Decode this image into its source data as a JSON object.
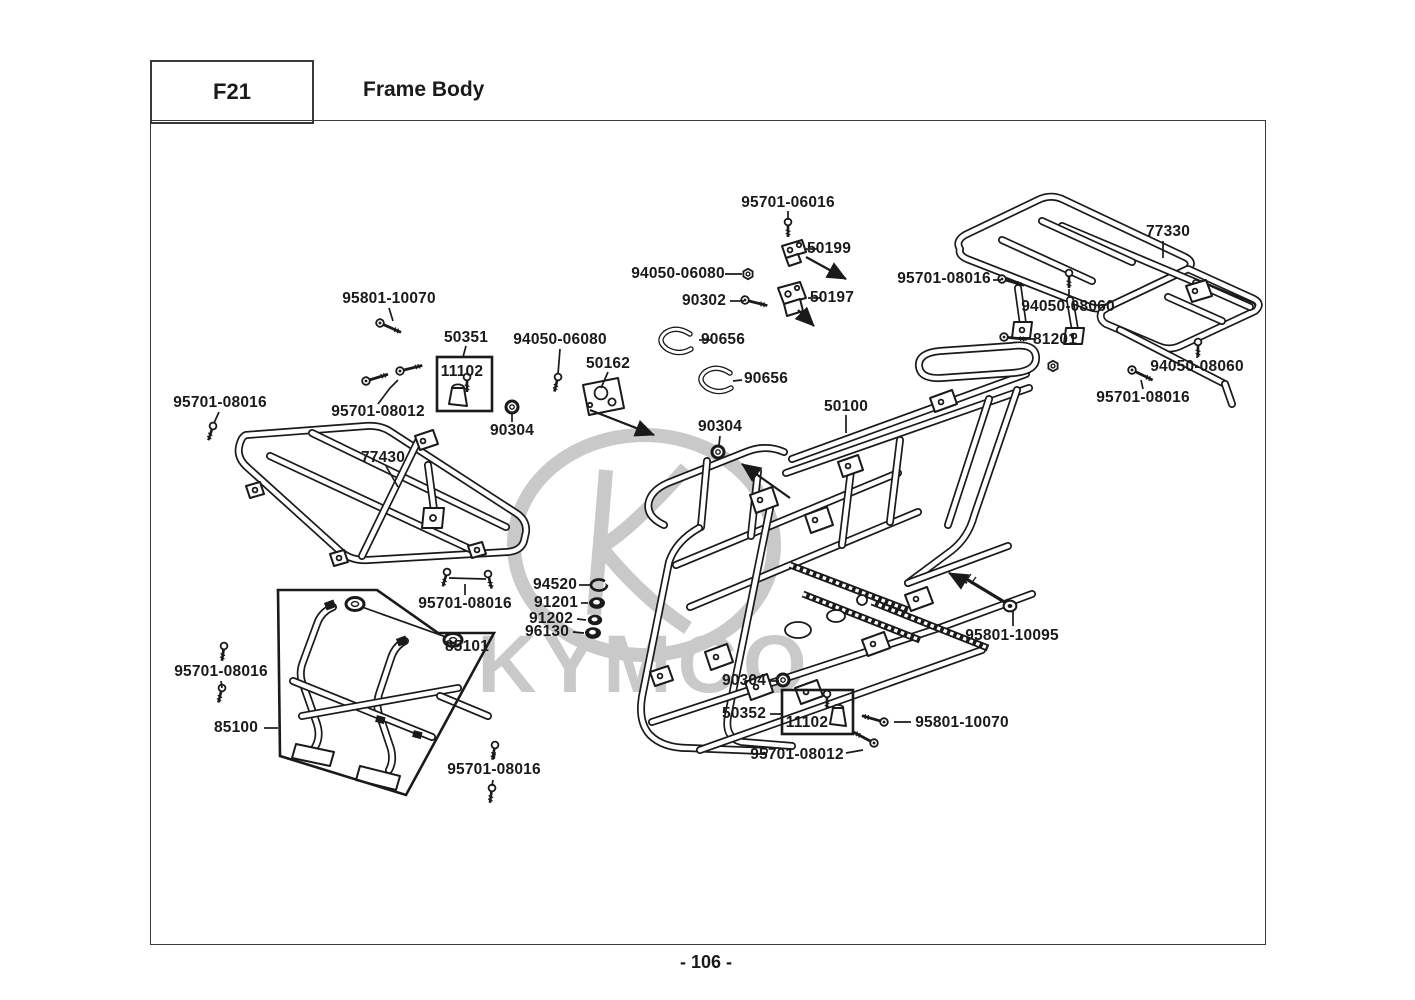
{
  "header": {
    "code": "F21",
    "title": "Frame Body"
  },
  "footer": {
    "page_label": "- 106 -"
  },
  "watermark": {
    "brand": "KYMCO"
  },
  "colors": {
    "line": "#1a1a1a",
    "watermark": "#c9c9c9",
    "background": "#ffffff"
  },
  "detail_boxes": [
    {
      "callout": "50351",
      "inner_part": "11102"
    },
    {
      "callout": "50352",
      "inner_part": "11102"
    },
    {
      "callout": "85100",
      "contains": [
        "85101"
      ]
    }
  ],
  "labels": [
    {
      "text": "95701-06016",
      "x": 788,
      "y": 203
    },
    {
      "text": "50199",
      "x": 829,
      "y": 249
    },
    {
      "text": "94050-06080",
      "x": 678,
      "y": 274
    },
    {
      "text": "90302",
      "x": 704,
      "y": 301
    },
    {
      "text": "50197",
      "x": 832,
      "y": 298
    },
    {
      "text": "77330",
      "x": 1168,
      "y": 232
    },
    {
      "text": "95701-08016",
      "x": 944,
      "y": 279
    },
    {
      "text": "94050-08060",
      "x": 1068,
      "y": 307
    },
    {
      "text": "95801-10070",
      "x": 389,
      "y": 299
    },
    {
      "text": "50351",
      "x": 466,
      "y": 338
    },
    {
      "text": "11102",
      "x": 462,
      "y": 372
    },
    {
      "text": "94050-06080",
      "x": 560,
      "y": 340
    },
    {
      "text": "50162",
      "x": 608,
      "y": 364
    },
    {
      "text": "95701-08012",
      "x": 378,
      "y": 412
    },
    {
      "text": "95701-08016",
      "x": 220,
      "y": 403
    },
    {
      "text": "90304",
      "x": 512,
      "y": 431
    },
    {
      "text": "77430",
      "x": 383,
      "y": 458
    },
    {
      "text": "90656",
      "x": 723,
      "y": 340
    },
    {
      "text": "90656",
      "x": 766,
      "y": 379
    },
    {
      "text": "81201",
      "x": 1055,
      "y": 340
    },
    {
      "text": "94050-08060",
      "x": 1197,
      "y": 367
    },
    {
      "text": "95701-08016",
      "x": 1143,
      "y": 398
    },
    {
      "text": "50100",
      "x": 846,
      "y": 407
    },
    {
      "text": "90304",
      "x": 720,
      "y": 427
    },
    {
      "text": "94520",
      "x": 555,
      "y": 585
    },
    {
      "text": "91201",
      "x": 556,
      "y": 603
    },
    {
      "text": "91202",
      "x": 551,
      "y": 619
    },
    {
      "text": "96130",
      "x": 547,
      "y": 632
    },
    {
      "text": "95801-10095",
      "x": 1012,
      "y": 636
    },
    {
      "text": "95701-08016",
      "x": 465,
      "y": 604
    },
    {
      "text": "85101",
      "x": 467,
      "y": 647
    },
    {
      "text": "95701-08016",
      "x": 221,
      "y": 672
    },
    {
      "text": "85100",
      "x": 236,
      "y": 728
    },
    {
      "text": "90304",
      "x": 744,
      "y": 681
    },
    {
      "text": "50352",
      "x": 744,
      "y": 714
    },
    {
      "text": "11102",
      "x": 807,
      "y": 723
    },
    {
      "text": "95801-10070",
      "x": 962,
      "y": 723
    },
    {
      "text": "95701-08012",
      "x": 797,
      "y": 755
    },
    {
      "text": "95701-08016",
      "x": 494,
      "y": 770
    }
  ]
}
